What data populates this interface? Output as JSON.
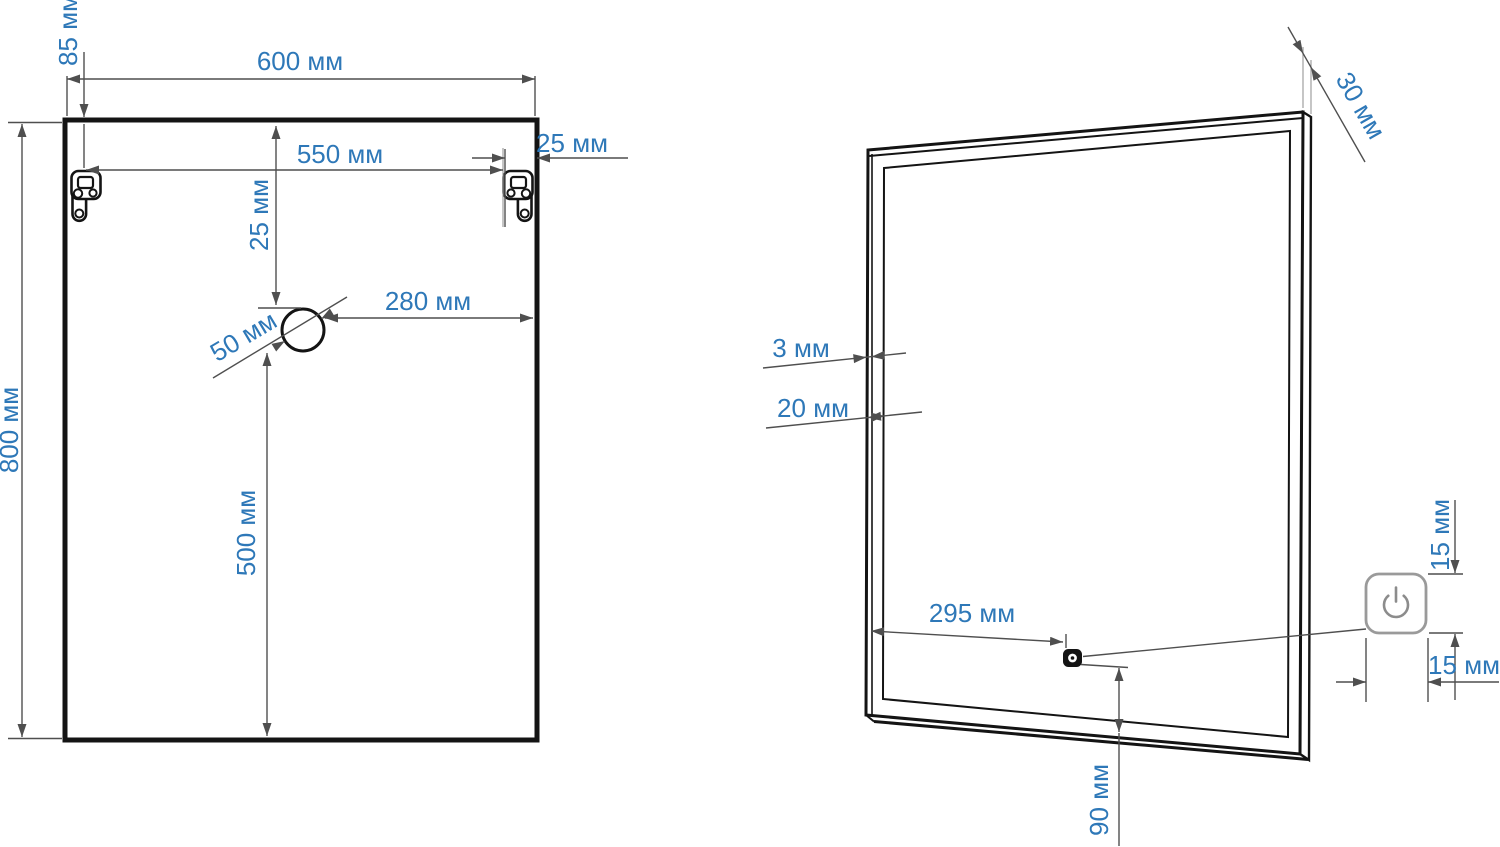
{
  "title": "Mirror installation dimensions drawing",
  "colors": {
    "dimension_text": "#2e78b8",
    "outline": "#141414",
    "dim_line": "#4f4f4f",
    "light_line": "#9f9f9f",
    "button_stroke": "#9a9a9a",
    "icon_color": "#8c8c8c"
  },
  "front_view": {
    "labels": {
      "width": "600 мм",
      "height": "800 мм",
      "hanger_top_offset": "85 мм",
      "hanger_spacing": "550 мм",
      "hanger_side_offset": "25 мм",
      "hole_top_offset": "25 мм",
      "hole_side_offset": "280 мм",
      "hole_diameter": "50 мм",
      "hole_bottom_offset": "500 мм"
    }
  },
  "side_view": {
    "labels": {
      "depth": "30 мм",
      "glass_thickness": "3 мм",
      "frame_width": "20 мм",
      "switch_side_offset": "295 мм",
      "button_height": "15 мм",
      "button_width": "15 мм",
      "switch_bottom_offset": "90 мм"
    }
  },
  "icons": {
    "power_button": "power-icon",
    "touch_sensor": "sensor-dot-icon"
  }
}
